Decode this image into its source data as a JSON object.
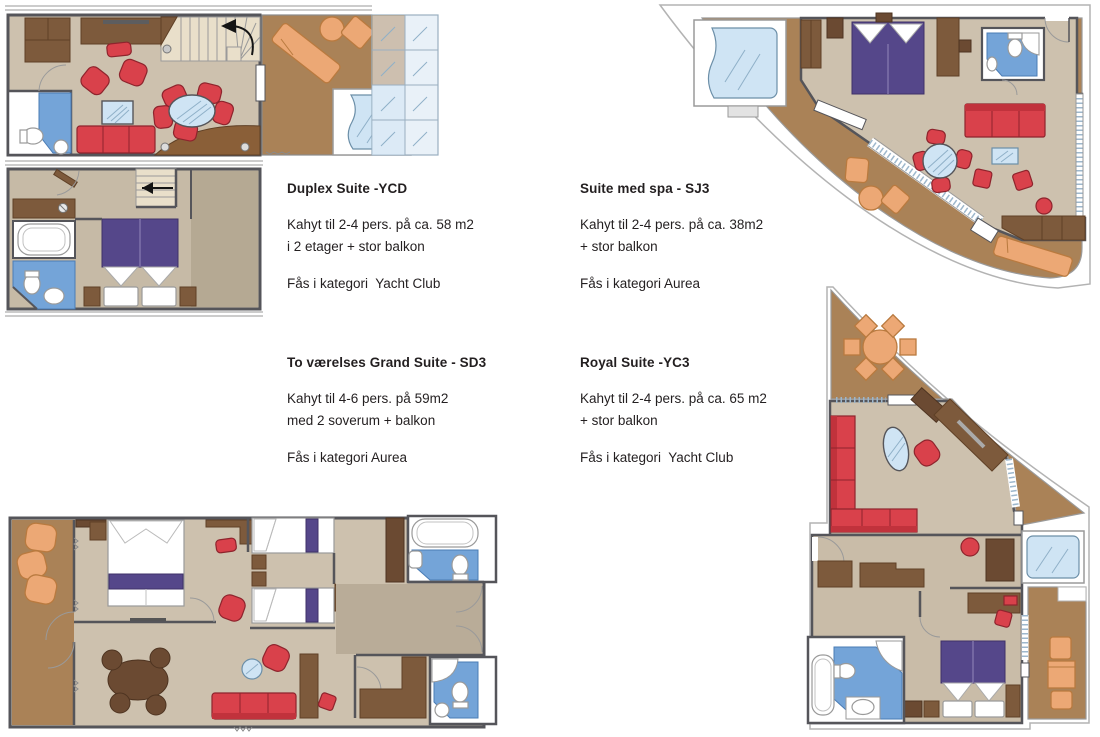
{
  "page_title": "MSC suite floor plans",
  "palette": {
    "floor_tan": "#cdc1ae",
    "floor_dark": "#b5a993",
    "balcony_deck": "#aa8257",
    "wood": "#7d5a3c",
    "wood_dark": "#6b4a32",
    "furniture_red": "#d9414b",
    "furniture_orange": "#eca875",
    "bed_purple": "#55478a",
    "bathroom_blue": "#74a4d8",
    "glass_blue": "#cfe4f4",
    "wall_gray": "#55555a",
    "text_color": "#231f20"
  },
  "suites": [
    {
      "id": "duplex",
      "title": "Duplex Suite -YCD",
      "line1": "Kahyt til 2-4 pers. på ca. 58 m2",
      "line2": "i 2 etager + stor balkon",
      "category": "Fås i kategori  Yacht Club"
    },
    {
      "id": "spa",
      "title": "Suite med spa - SJ3",
      "line1": "Kahyt til 2-4 pers. på ca. 38m2",
      "line2": "+ stor balkon",
      "category": "Fås i kategori Aurea"
    },
    {
      "id": "grand",
      "title": "To værelses Grand Suite - SD3",
      "line1": "Kahyt til 4-6 pers. på 59m2",
      "line2": "med 2 soverum + balkon",
      "category": "Fås i kategori Aurea"
    },
    {
      "id": "royal",
      "title": "Royal Suite -YC3",
      "line1": "Kahyt til 2-4 pers. på ca. 65 m2",
      "line2": "+ stor balkon",
      "category": "Fås i kategori  Yacht Club"
    }
  ]
}
